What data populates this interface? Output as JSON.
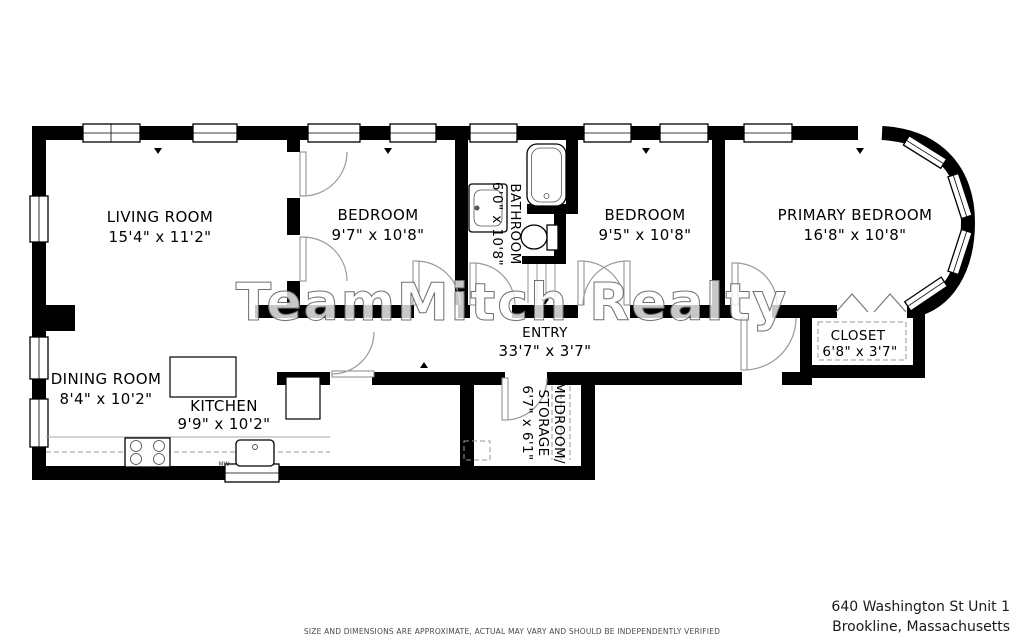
{
  "rooms": {
    "living": {
      "name": "LIVING ROOM",
      "dims": "15'4\" x 11'2\""
    },
    "bedroom1": {
      "name": "BEDROOM",
      "dims": "9'7\" x 10'8\""
    },
    "bathroom": {
      "name": "BATHROOM",
      "dims": "6'0\" x 10'8\""
    },
    "bedroom2": {
      "name": "BEDROOM",
      "dims": "9'5\" x 10'8\""
    },
    "primary": {
      "name": "PRIMARY BEDROOM",
      "dims": "16'8\" x 10'8\""
    },
    "closet": {
      "name": "CLOSET",
      "dims": "6'8\" x 3'7\""
    },
    "entry": {
      "name": "ENTRY",
      "dims": "33'7\" x 3'7\""
    },
    "dining": {
      "name": "DINING ROOM",
      "dims": "8'4\" x 10'2\""
    },
    "kitchen": {
      "name": "KITCHEN",
      "dims": "9'9\" x 10'2\""
    },
    "mudroom": {
      "line1": "MUDROOM/",
      "line2": "STORAGE",
      "dims": "6'7\" x 6'1\""
    }
  },
  "labels": {
    "microwave": "MW"
  },
  "watermark": {
    "text": "TeamMitch Realty"
  },
  "footer": {
    "address_line1": "640 Washington St Unit 1",
    "address_line2": "Brookline, Massachusetts",
    "disclaimer": "SIZE AND DIMENSIONS ARE APPROXIMATE, ACTUAL MAY VARY AND SHOULD BE INDEPENDENTLY VERIFIED"
  },
  "colors": {
    "wall": "#000000",
    "door_arc": "#999999",
    "dashed": "#9a9a9a",
    "text": "#000000",
    "disclaimer_text": "#4a4a4a"
  }
}
